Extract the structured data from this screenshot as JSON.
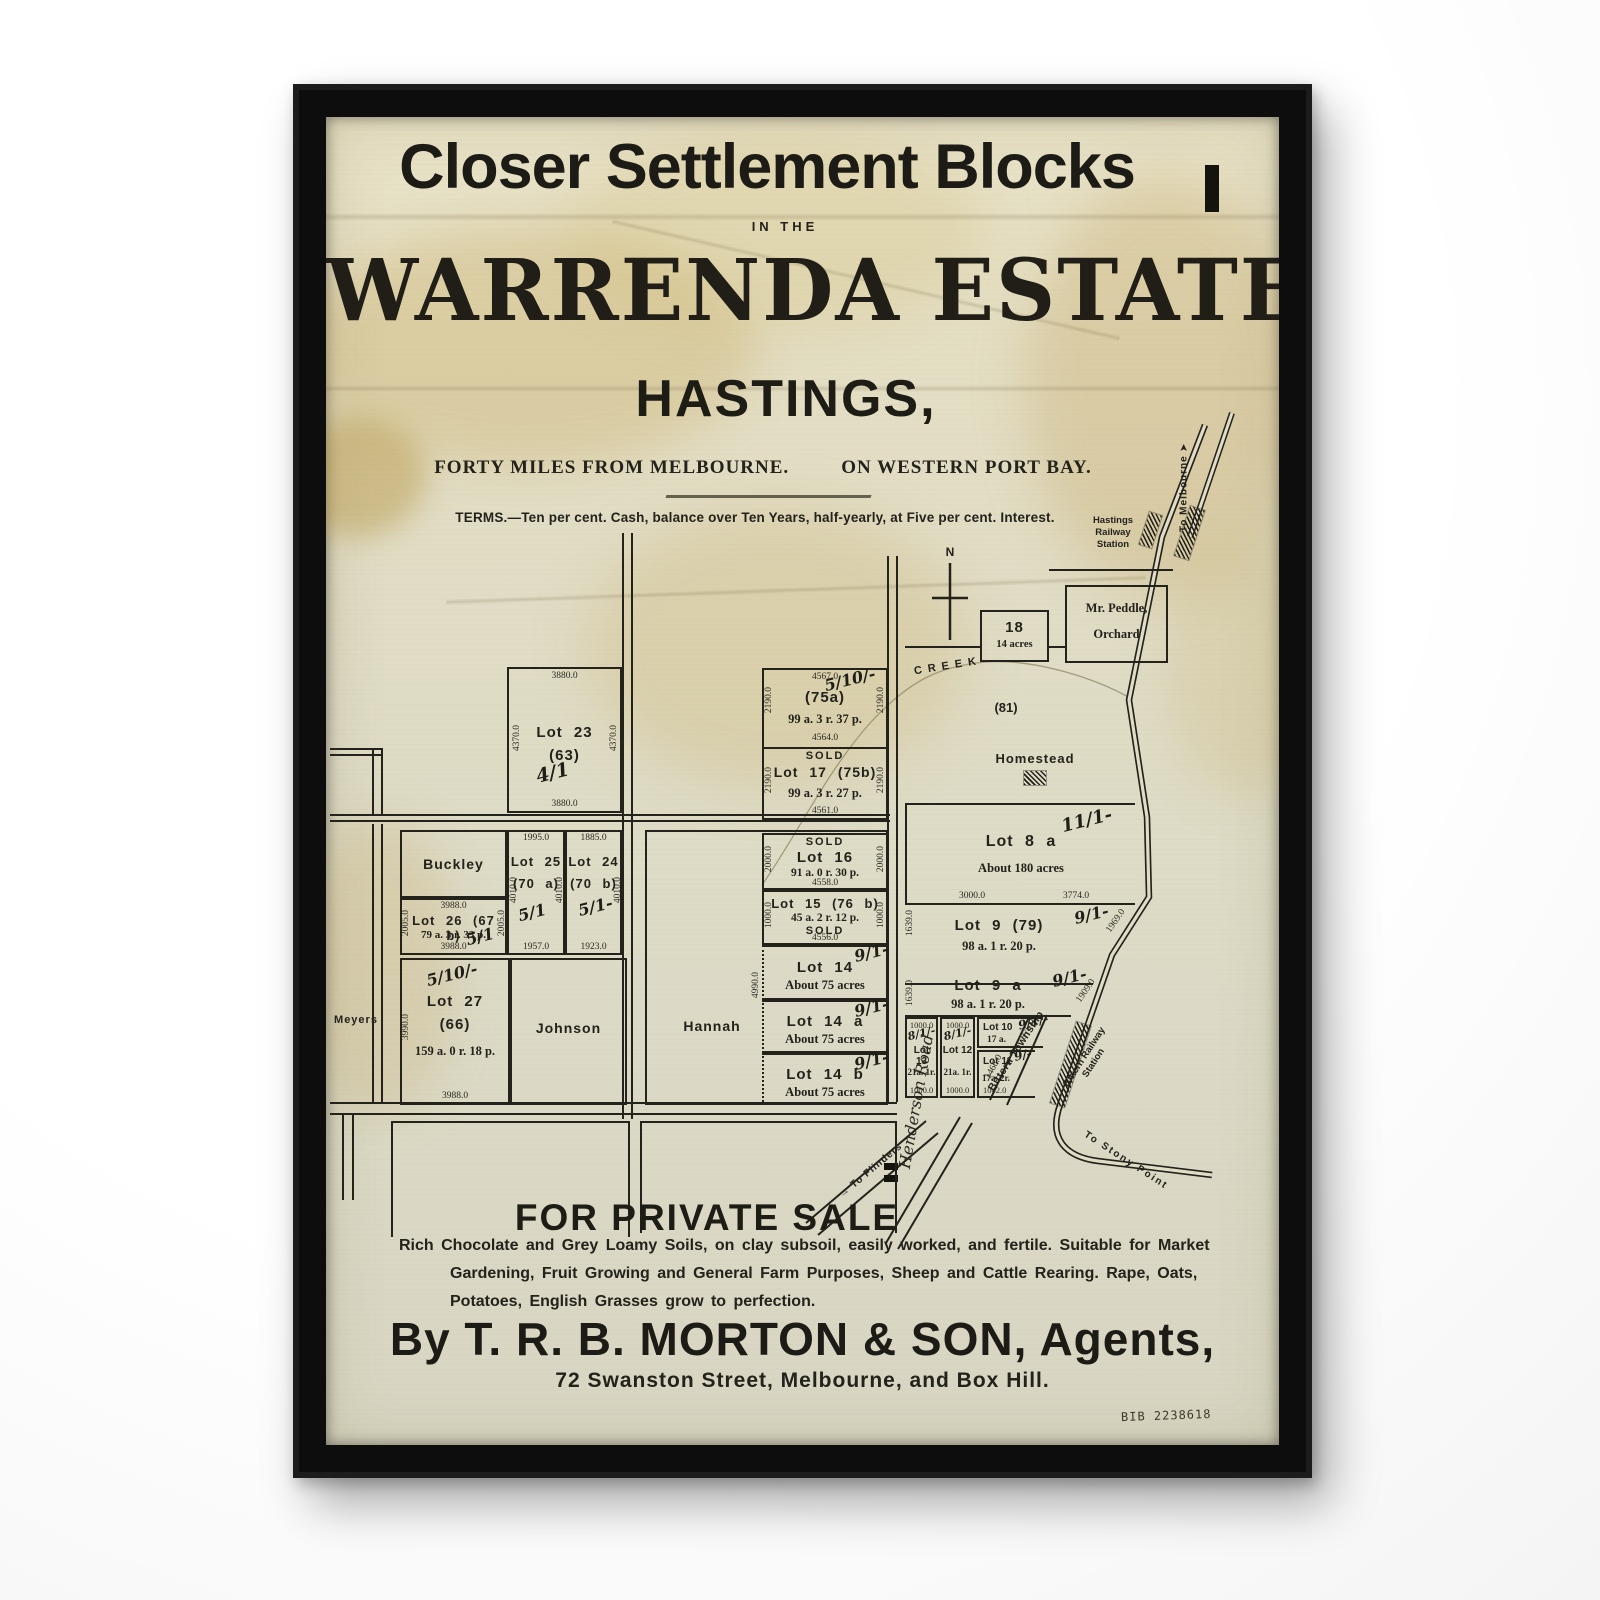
{
  "poster": {
    "title": "Closer Settlement Blocks",
    "in_the": "IN THE",
    "estate_name": "WARRENDA ESTATE",
    "town": "HASTINGS,",
    "subtitle_left": "FORTY MILES FROM MELBOURNE.",
    "subtitle_right": "ON WESTERN PORT BAY.",
    "terms": "TERMS.—Ten per cent. Cash, balance over Ten Years, half-yearly, at Five per cent. Interest.",
    "sale_heading": "FOR PRIVATE SALE",
    "description": {
      "line1": "Rich Chocolate and Grey Loamy Soils, on clay subsoil, easily worked, and fertile.  Suitable for Market",
      "line2": "Gardening, Fruit Growing and General Farm Purposes, Sheep and Cattle Rearing.  Rape, Oats,",
      "line3": "Potatoes, English Grasses grow to perfection."
    },
    "agent_line": "By T. R. B. MORTON & SON, Agents,",
    "address_line": "72 Swanston Street, Melbourne, and Box Hill.",
    "catalog_number": "BIB 2238618"
  },
  "map": {
    "sold_label": "SOLD",
    "north_label": "N",
    "creek_label": "CREEK",
    "icons": {
      "up_arrow": "➤"
    },
    "places": {
      "hastings_station": "Hastings Railway Station",
      "to_melbourne": "To Melbourne",
      "to_flinders": "→ To Flinders",
      "to_stony_point": "To Stony Point",
      "henderson_road": "Henderson Road",
      "bittern_township": "Bittern Township",
      "bittern_station": "Bittern Railway Station",
      "homestead": "Homestead",
      "block_81": "(81)"
    },
    "owners": {
      "buckley": "Buckley",
      "johnson": "Johnson",
      "hannah": "Hannah",
      "meyers": "Meyers",
      "peddle_line1": "Mr. Peddle,",
      "peddle_line2": "Orchard"
    },
    "lots": {
      "lot23": {
        "name": "Lot 23",
        "number": "(63)",
        "price": "4/1",
        "dim_top": "3880.0",
        "dim_bottom": "3880.0",
        "dim_left": "4370.0",
        "dim_right": "4370.0"
      },
      "lot75a": {
        "name": "(75a)",
        "area": "99 a. 3 r. 37 p.",
        "price": "5/10/-",
        "dim_top": "4567.0",
        "dim_bottom": "4564.0",
        "dim_left": "2190.0",
        "dim_right": "2190.0"
      },
      "lot17": {
        "name": "Lot 17 (75b)",
        "area": "99 a. 3 r. 27 p.",
        "dim_bottom": "4561.0",
        "dim_left": "2190.0",
        "dim_right": "2190.0"
      },
      "lot16": {
        "name": "Lot 16",
        "area": "91 a. 0 r. 30 p.",
        "dim_bottom": "4558.0",
        "dim_left": "2000.0",
        "dim_right": "2000.0"
      },
      "lot15": {
        "name": "Lot 15 (76 b)",
        "area": "45 a. 2 r. 12 p.",
        "dim_bottom": "4556.0",
        "dim_left": "1000.0",
        "dim_right": "1000.0"
      },
      "lot14": {
        "name": "Lot 14",
        "area": "About 75 acres",
        "price": "9/1-"
      },
      "lot14a": {
        "name": "Lot 14 a",
        "area": "About 75 acres",
        "price": "9/1-"
      },
      "lot14b": {
        "name": "Lot 14 b",
        "area": "About 75 acres",
        "price": "9/1-"
      },
      "lot18": {
        "name": "18",
        "area": "14 acres"
      },
      "lot8a": {
        "name": "Lot 8 a",
        "area": "About 180 acres",
        "price": "11/1-",
        "dim_bottom_left": "3000.0",
        "dim_bottom_right": "3774.0"
      },
      "lot9": {
        "name": "Lot 9 (79)",
        "area": "98 a. 1 r. 20 p.",
        "price": "9/1-",
        "dim_left": "1639.0",
        "dim_diag": "1969.0"
      },
      "lot9a": {
        "name": "Lot 9 a",
        "area": "98 a. 1 r. 20 p.",
        "price": "9/1-",
        "dim_left": "1639.0",
        "dim_diag": "1909.0"
      },
      "lot13": {
        "name": "Lot 13",
        "area": "21a. 1r.",
        "price": "8/1/-",
        "dim_top": "1000.0",
        "dim_bottom": "1000.0"
      },
      "lot12": {
        "name": "Lot 12",
        "area": "21a. 1r.",
        "price": "8/1/-",
        "dim_top": "1000.0",
        "dim_bottom": "1000.0"
      },
      "lot10": {
        "name": "Lot 10",
        "area": "17 a.",
        "price": "9/1/-",
        "dim_diag": "976.0"
      },
      "lot11": {
        "name": "Lot 11",
        "area": "17a. 2r.",
        "price": "9/-",
        "dim_bottom": "1042.0",
        "dim_diag": "1466.0"
      },
      "lot25": {
        "name": "Lot 25",
        "number": "(70 a)",
        "price": "5/1",
        "dim_top": "1995.0",
        "dim_bottom": "1957.0",
        "dim_left": "4010.0",
        "dim_right": "4010.0"
      },
      "lot24": {
        "name": "Lot 24",
        "number": "(70 b)",
        "price": "5/1-",
        "dim_top": "1885.0",
        "dim_bottom": "1923.0",
        "dim_right": "4010.0"
      },
      "lot26": {
        "name": "Lot 26 (67 b)",
        "area": "79 a. 3 r. 33 p.",
        "price": "5/1",
        "dim_top": "3988.0",
        "dim_bottom": "3988.0",
        "dim_left": "2005.0",
        "dim_right": "2005.0"
      },
      "lot27": {
        "name": "Lot 27",
        "number": "(66)",
        "area": "159 a. 0 r. 18 p.",
        "price": "5/10/-",
        "dim_left": "3990.0",
        "dim_bottom": "3988.0"
      },
      "henderson_frontage": {
        "dim": "4990.0"
      }
    }
  },
  "colors": {
    "paper": "#e0dcc6",
    "ink": "#23221b",
    "frame": "#0d0d0d",
    "stain": "#c8a963"
  }
}
